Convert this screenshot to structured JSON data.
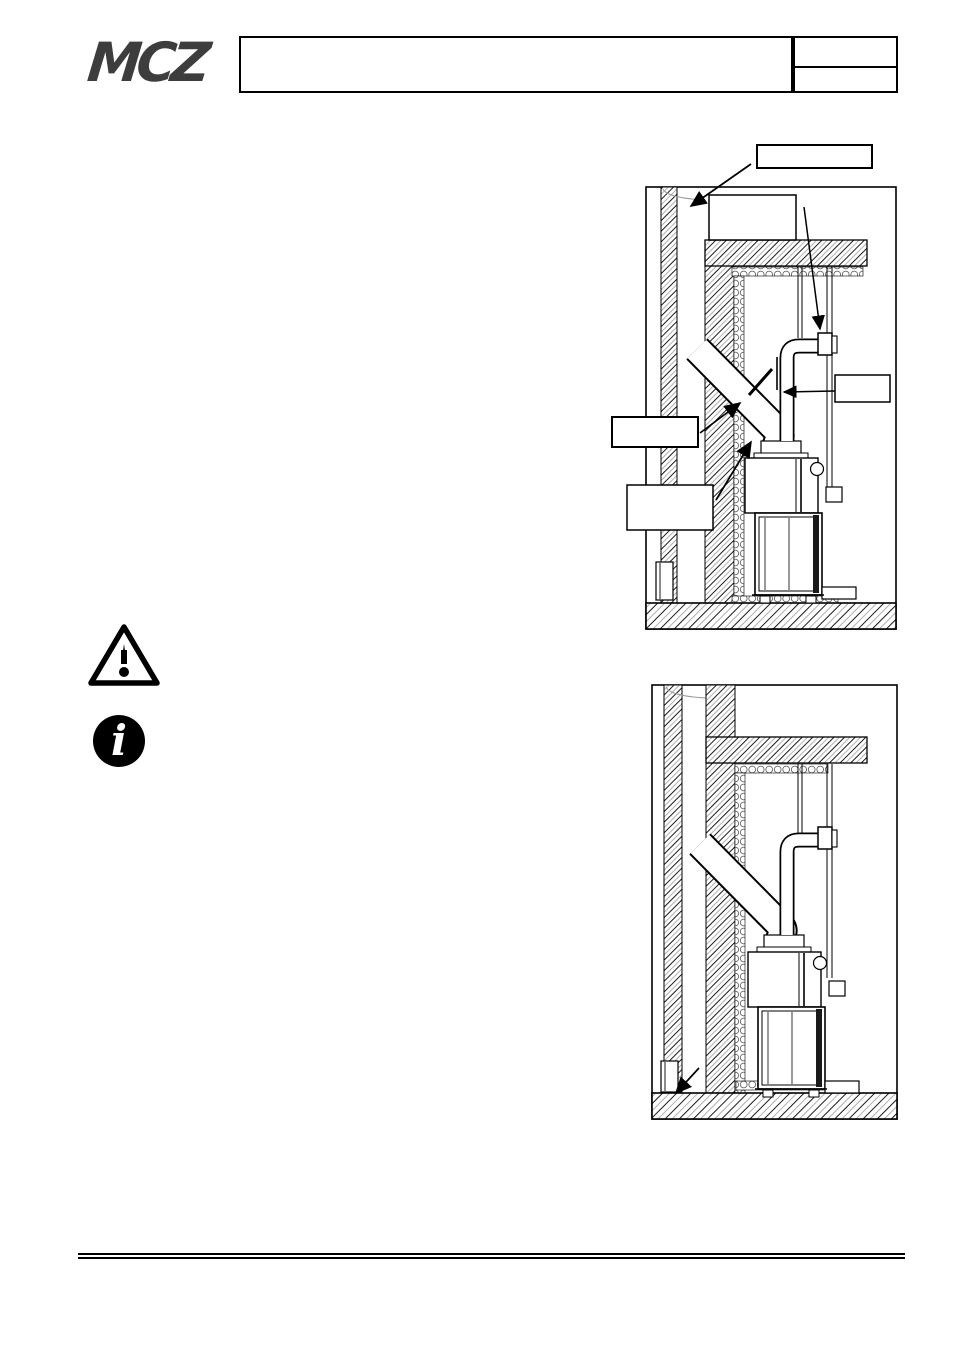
{
  "header": {
    "logo_text": "MCZ",
    "title_box_text": "",
    "doc_ref_top": "",
    "doc_ref_bottom": ""
  },
  "notices": {
    "warning_icon": "warning-triangle",
    "info_icon": "info-circle"
  },
  "figure_top": {
    "description": "section view of fireplace insert installed under counter-hood with inclined flue connection into wall chimney and external air pipe with wall sleeve",
    "callouts": [
      "",
      "",
      "",
      "",
      ""
    ]
  },
  "figure_bottom": {
    "description": "same installation section without callout boxes, arrow pointing to floor-level air vent in wall",
    "callouts": []
  },
  "colors": {
    "line": "#000000",
    "hatch_gray": "#9b9b9b",
    "logo_gray": "#3d3d3d",
    "insulation_gray": "#666666"
  }
}
